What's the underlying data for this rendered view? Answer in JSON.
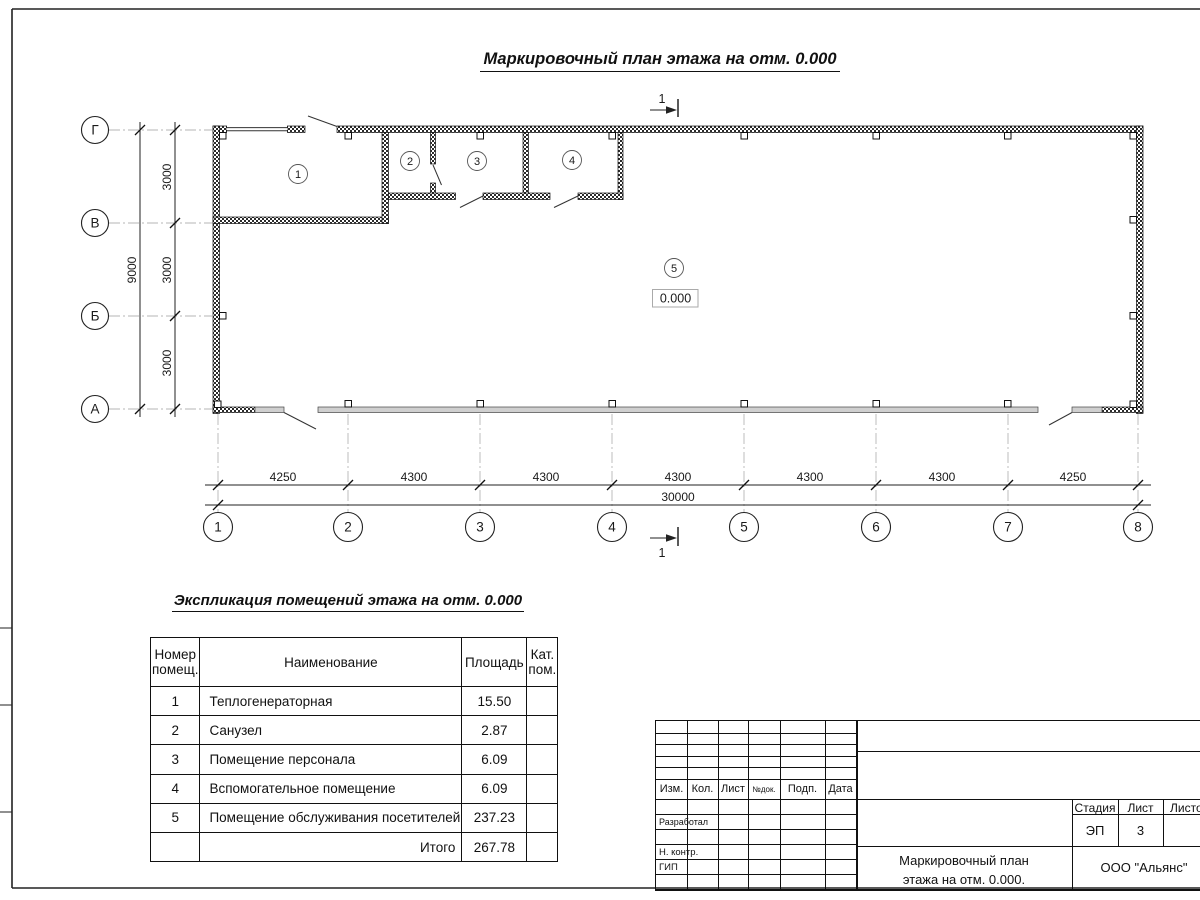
{
  "sheet": {
    "main_title": "Маркировочный план этажа на отм. 0.000",
    "section_mark": "1"
  },
  "plan": {
    "elevation": "0.000",
    "rooms": [
      "1",
      "2",
      "3",
      "4",
      "5"
    ],
    "axes_bottom": [
      "1",
      "2",
      "3",
      "4",
      "5",
      "6",
      "7",
      "8"
    ],
    "axes_left": [
      "Г",
      "В",
      "Б",
      "А"
    ],
    "dims_bottom": [
      "4250",
      "4300",
      "4300",
      "4300",
      "4300",
      "4300",
      "4250"
    ],
    "dim_bottom_total": "30000",
    "dims_left": [
      "3000",
      "3000",
      "3000"
    ],
    "dim_left_total": "9000"
  },
  "exposition": {
    "title": "Экспликация помещений этажа на отм. 0.000",
    "col_number": "Номер помещ.",
    "col_name": "Наименование",
    "col_area": "Площадь",
    "col_category": "Кат. пом.",
    "rows": [
      {
        "num": "1",
        "name": "Теплогенераторная",
        "area": "15.50",
        "cat": ""
      },
      {
        "num": "2",
        "name": "Санузел",
        "area": "2.87",
        "cat": ""
      },
      {
        "num": "3",
        "name": "Помещение персонала",
        "area": "6.09",
        "cat": ""
      },
      {
        "num": "4",
        "name": "Вспомогательное помещение",
        "area": "6.09",
        "cat": ""
      },
      {
        "num": "5",
        "name": "Помещение обслуживания посетителей",
        "area": "237.23",
        "cat": ""
      }
    ],
    "total_label": "Итого",
    "total_value": "267.78"
  },
  "title_block": {
    "rev_columns": [
      "Изм.",
      "Кол.",
      "Лист",
      "№док.",
      "Подп.",
      "Дата"
    ],
    "role_developed": "Разработал",
    "role_ncontrol": "Н. контр.",
    "role_gip": "ГИП",
    "stage_label": "Стадия",
    "sheet_label": "Лист",
    "sheets_label": "Листов",
    "stage_value": "ЭП",
    "sheet_value": "3",
    "doc_title": "Маркировочный план этажа на отм. 0.000.",
    "company": "ООО \"Альянс\""
  }
}
